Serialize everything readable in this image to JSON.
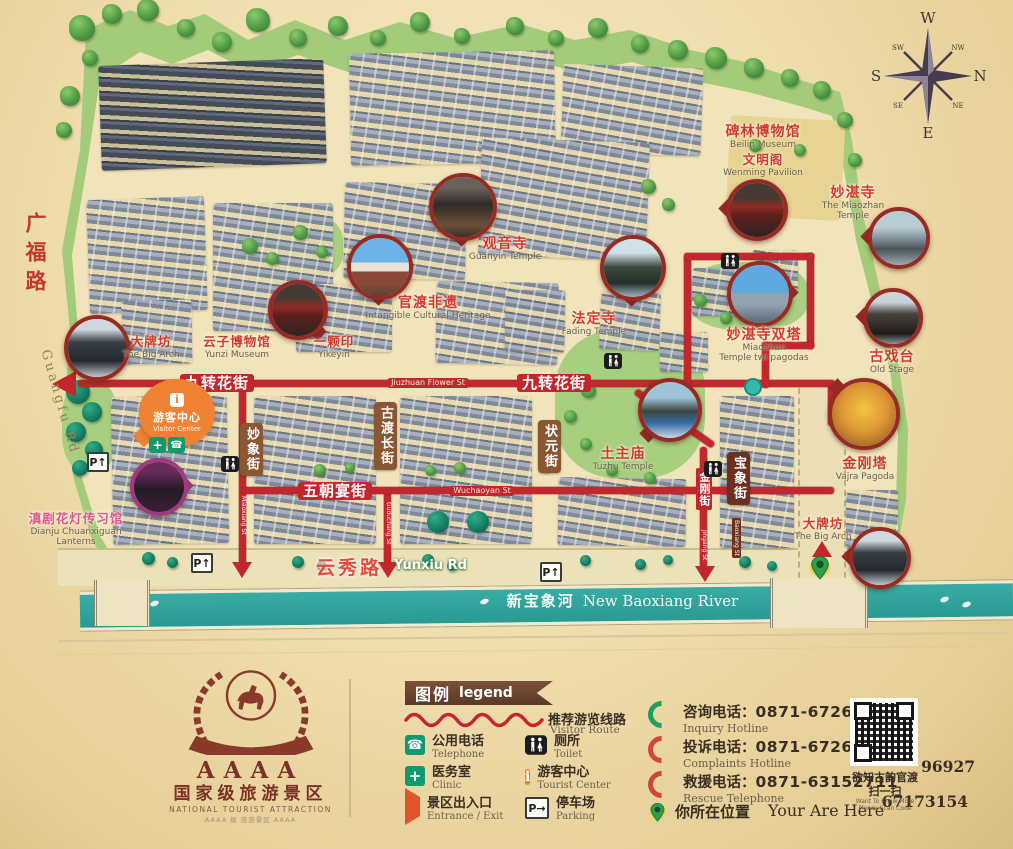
{
  "colors": {
    "route_red": "#c1272d",
    "river_teal": "#2fa39b",
    "poi_red": "#cf3a30",
    "legend_brown": "#6a4530",
    "accent_orange": "#f08233",
    "green": "#a3cb79"
  },
  "compass": {
    "n": "N",
    "e": "E",
    "s": "S",
    "w": "W",
    "ne": "NE",
    "nw": "NW",
    "se": "SE",
    "sw": "SW"
  },
  "roads": {
    "guangfu_cn": "广福路",
    "guangfu_en": "Guangfu Rd",
    "yunxiu_cn": "云秀路",
    "yunxiu_en": "Yunxiu Rd",
    "river_cn": "新宝象河",
    "river_en": "New Baoxiang River"
  },
  "route_labels": [
    {
      "text": "九转花街",
      "x": 217,
      "y": 383,
      "type": "cn"
    },
    {
      "text": "Jiuzhuan Flower St",
      "x": 428,
      "y": 383,
      "type": "en"
    },
    {
      "text": "九转花街",
      "x": 554,
      "y": 383,
      "type": "cn"
    },
    {
      "text": "五朝宴街",
      "x": 335,
      "y": 491,
      "type": "cn"
    },
    {
      "text": "Wuchaoyan St",
      "x": 482,
      "y": 491,
      "type": "en"
    }
  ],
  "street_signs": [
    {
      "text": "妙象街",
      "x": 250,
      "y": 423
    },
    {
      "text": "古渡长街",
      "x": 384,
      "y": 402
    },
    {
      "text": "状元街",
      "x": 548,
      "y": 420
    },
    {
      "text": "宝象街",
      "x": 737,
      "y": 452,
      "dark": true,
      "sub": "Baoxiang St"
    }
  ],
  "route_vtexts": [
    {
      "text": "金刚街",
      "x": 704,
      "y": 468,
      "cn": true
    },
    {
      "text": "Jingang St",
      "x": 704,
      "y": 530,
      "tiny": true
    },
    {
      "text": "Miaoxiang St",
      "x": 243,
      "y": 496,
      "tiny": true
    },
    {
      "text": "Guduchang St",
      "x": 388,
      "y": 502,
      "tiny": true
    }
  ],
  "pois": [
    {
      "id": "beilin-museum",
      "cn": "碑林博物馆",
      "en": "Beilin Museum",
      "x": 763,
      "y": 124
    },
    {
      "id": "wenming-pavilion",
      "cn": "文明阁",
      "en": "Wenming Pavilion",
      "x": 763,
      "y": 152,
      "sm": true
    },
    {
      "id": "miaozhan-temple",
      "cn": "妙湛寺",
      "en": "The Miaozhan",
      "en2": "Temple",
      "x": 853,
      "y": 185
    },
    {
      "id": "guanyin-temple",
      "cn": "观音寺",
      "en": "Guanyin Temple",
      "x": 505,
      "y": 236
    },
    {
      "id": "guandu-heritage",
      "cn": "官渡非遗",
      "en": "Intangible Cultural Heritage",
      "x": 428,
      "y": 295
    },
    {
      "id": "fading-temple",
      "cn": "法定寺",
      "en": "Fading Temple",
      "x": 594,
      "y": 311
    },
    {
      "id": "twin-pagodas",
      "cn": "妙湛寺双塔",
      "en": "Miaozhan",
      "en2": "Temple twi pagodas",
      "x": 764,
      "y": 327
    },
    {
      "id": "old-stage",
      "cn": "古戏台",
      "en": "Old Stage",
      "x": 892,
      "y": 349
    },
    {
      "id": "big-arch-west",
      "cn": "大牌坊",
      "en": "The Big Arch",
      "x": 151,
      "y": 334,
      "sm": true
    },
    {
      "id": "yunzi-museum",
      "cn": "云子博物馆",
      "en": "Yunzi Museum",
      "x": 237,
      "y": 334,
      "sm": true
    },
    {
      "id": "yikeyin",
      "cn": "一颗印",
      "en": "Yikeyin",
      "x": 334,
      "y": 334,
      "sm": true
    },
    {
      "id": "tuzhu-temple",
      "cn": "土主庙",
      "en": "Tuzhu Temple",
      "x": 623,
      "y": 446
    },
    {
      "id": "vajra-pagoda",
      "cn": "金刚塔",
      "en": "Vajra Pagoda",
      "x": 865,
      "y": 456
    },
    {
      "id": "big-arch-southeast",
      "cn": "大牌坊",
      "en": "The Big Arch",
      "x": 823,
      "y": 516,
      "sm": true
    },
    {
      "id": "dianju-lanterns",
      "cn": "滇剧花灯传习馆",
      "en": "Dianju Chuanxiguan",
      "en2": "Lanterns",
      "x": 76,
      "y": 511,
      "pink": true,
      "sm": true
    }
  ],
  "photos": [
    {
      "id": "photo-guanyin-temple",
      "x": 463,
      "y": 207,
      "r": 34,
      "style": "temple-dark",
      "tail": "b"
    },
    {
      "id": "photo-heritage",
      "x": 380,
      "y": 267,
      "r": 33,
      "style": "sky",
      "tail": "b"
    },
    {
      "id": "photo-yikeyin",
      "x": 298,
      "y": 310,
      "r": 30,
      "style": "lantern",
      "tail": "br"
    },
    {
      "id": "photo-big-arch-west",
      "x": 97,
      "y": 348,
      "r": 33,
      "style": "arch",
      "tail": "r"
    },
    {
      "id": "photo-fading-temple",
      "x": 633,
      "y": 268,
      "r": 33,
      "style": "temple-sky",
      "tail": "b"
    },
    {
      "id": "photo-miaozhan-gate",
      "x": 757,
      "y": 210,
      "r": 31,
      "style": "lantern",
      "tail": "l"
    },
    {
      "id": "photo-miaozhan-court",
      "x": 899,
      "y": 238,
      "r": 31,
      "style": "court",
      "tail": "l"
    },
    {
      "id": "photo-old-stage",
      "x": 893,
      "y": 318,
      "r": 30,
      "style": "stage",
      "tail": "l"
    },
    {
      "id": "photo-twin-pagodas",
      "x": 760,
      "y": 294,
      "r": 33,
      "style": "sky2",
      "tail": "r"
    },
    {
      "id": "photo-tuzhu-temple",
      "x": 670,
      "y": 410,
      "r": 32,
      "style": "temple-blue",
      "tail": "bl"
    },
    {
      "id": "photo-vajra-pagoda",
      "x": 864,
      "y": 414,
      "r": 36,
      "style": "gold",
      "tail": "tl"
    },
    {
      "id": "photo-big-arch-southeast",
      "x": 880,
      "y": 558,
      "r": 31,
      "style": "arch",
      "tail": "l"
    },
    {
      "id": "photo-dianju-lanterns",
      "x": 159,
      "y": 487,
      "r": 29,
      "style": "purple",
      "tail": "r",
      "purple": true
    }
  ],
  "map_icons": [
    {
      "type": "toilet",
      "x": 230,
      "y": 464
    },
    {
      "type": "toilet",
      "x": 613,
      "y": 361
    },
    {
      "type": "toilet",
      "x": 730,
      "y": 261
    },
    {
      "type": "toilet",
      "x": 713,
      "y": 469
    },
    {
      "type": "parking",
      "x": 96,
      "y": 460,
      "glyph": "P↑"
    },
    {
      "type": "parking",
      "x": 200,
      "y": 561,
      "glyph": "P↑"
    },
    {
      "type": "parking",
      "x": 549,
      "y": 570,
      "glyph": "P↑"
    },
    {
      "type": "clinic",
      "x": 158,
      "y": 445,
      "glyph": "+"
    },
    {
      "type": "phone",
      "x": 177,
      "y": 445,
      "glyph": "☎"
    },
    {
      "type": "pin",
      "x": 808,
      "y": 553
    },
    {
      "type": "dot",
      "x": 744,
      "y": 378
    }
  ],
  "arrows": [
    {
      "dir": "left",
      "x": 52,
      "y": 371
    },
    {
      "dir": "down",
      "x": 232,
      "y": 562
    },
    {
      "dir": "down",
      "x": 378,
      "y": 562
    },
    {
      "dir": "down",
      "x": 695,
      "y": 566
    },
    {
      "dir": "up",
      "x": 812,
      "y": 541
    }
  ],
  "visitor_center": {
    "cn": "游客中心",
    "en": "Visitor Center"
  },
  "legend": {
    "title_cn": "图例",
    "title_en": "legend",
    "route_cn": "推荐游览线路",
    "route_en": "Visitor Route",
    "items": [
      {
        "icon": "phone",
        "cn": "公用电话",
        "en": "Telephone"
      },
      {
        "icon": "toilet",
        "cn": "厕所",
        "en": "Toilet"
      },
      {
        "icon": "clinic",
        "cn": "医务室",
        "en": "Clinic"
      },
      {
        "icon": "tourist",
        "cn": "游客中心",
        "en": "Tourist Center"
      },
      {
        "icon": "entrance",
        "cn": "景区出入口",
        "en": "Entrance / Exit"
      },
      {
        "icon": "parking",
        "cn": "停车场",
        "en": "Parking"
      }
    ]
  },
  "hotlines": [
    {
      "icon": "phone-green",
      "label": "咨询电话：",
      "num": "0871-67262799",
      "en": "Inquiry Hotline",
      "num2": ""
    },
    {
      "icon": "phone-red",
      "label": "投诉电话：",
      "num": "0871-67262799",
      "en": "Complaints Hotline",
      "num2": "96927"
    },
    {
      "icon": "phone-red",
      "label": "救援电话：",
      "num": "0871-63152711",
      "en": "Rescue Telephone",
      "num2": "67173154"
    }
  ],
  "you_are_here": {
    "cn": "你所在位置",
    "en": "Your Are Here"
  },
  "qr": {
    "cn": "欲知古韵官渡",
    "cn2": "扫一扫",
    "en": "Want To Know More",
    "en2": "Please Scan Code"
  },
  "logo": {
    "stars": "AAAA",
    "cn": "国家级旅游景区",
    "en": "NATIONAL TOURIST ATTRACTION",
    "sub": "AAAA 级 旅游景区 AAAA"
  }
}
